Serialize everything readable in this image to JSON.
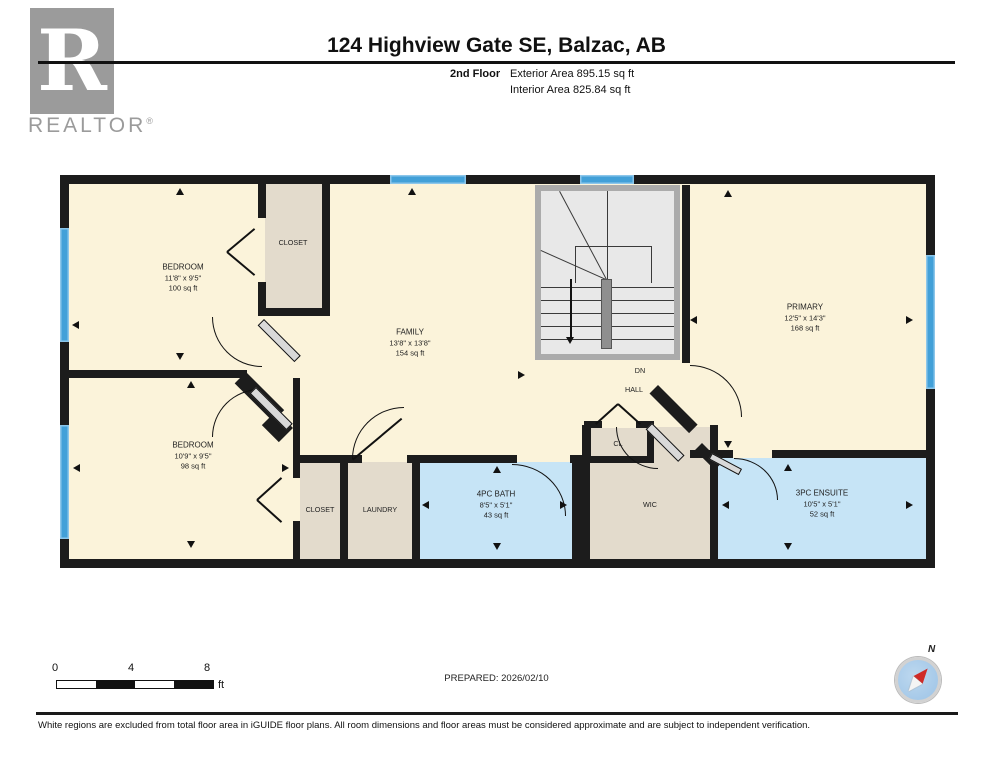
{
  "header": {
    "title": "124 Highview Gate SE, Balzac, AB",
    "floor_label": "2nd Floor",
    "exterior_area": "Exterior Area 895.15 sq ft",
    "interior_area": "Interior Area 825.84 sq ft"
  },
  "logo": {
    "letter": "R",
    "brand": "REALTOR",
    "registered": "®"
  },
  "plan": {
    "rooms": {
      "bedroom1": {
        "name": "BEDROOM",
        "dims": "11'8\" x 9'5\"",
        "area": "100 sq ft"
      },
      "bedroom2": {
        "name": "BEDROOM",
        "dims": "10'9\" x 9'5\"",
        "area": "98 sq ft"
      },
      "family": {
        "name": "FAMILY",
        "dims": "13'8\" x 13'8\"",
        "area": "154 sq ft"
      },
      "primary": {
        "name": "PRIMARY",
        "dims": "12'5\" x 14'3\"",
        "area": "168 sq ft"
      },
      "bath4pc": {
        "name": "4PC BATH",
        "dims": "8'5\" x 5'1\"",
        "area": "43 sq ft"
      },
      "ensuite": {
        "name": "3PC ENSUITE",
        "dims": "10'5\" x 5'1\"",
        "area": "52 sq ft"
      },
      "closet_top": {
        "name": "CLOSET"
      },
      "closet_bottom": {
        "name": "CLOSET"
      },
      "laundry": {
        "name": "LAUNDRY"
      },
      "wic": {
        "name": "WIC"
      },
      "cl": {
        "name": "CL"
      },
      "hall": {
        "name": "HALL"
      },
      "dn": {
        "name": "DN"
      }
    }
  },
  "scalebar": {
    "tick0": "0",
    "tick1": "4",
    "tick2": "8",
    "unit": "ft"
  },
  "prepared_label": "PREPARED: 2026/02/10",
  "compass": {
    "north_label": "N"
  },
  "footer": {
    "disclaimer": "White regions are excluded from total floor area in iGUIDE floor plans. All room dimensions and floor areas must be considered approximate and are subject to independent verification."
  },
  "colors": {
    "room_fill": "#fbf3da",
    "closet_fill": "#e3dbcc",
    "bath_fill": "#c6e4f6",
    "window_blue": "#42a0d8",
    "wall": "#1c1c1c",
    "stair_fill": "#e8e8e8",
    "logo_gray": "#9b9b9b",
    "compass_red": "#cf2a27"
  }
}
